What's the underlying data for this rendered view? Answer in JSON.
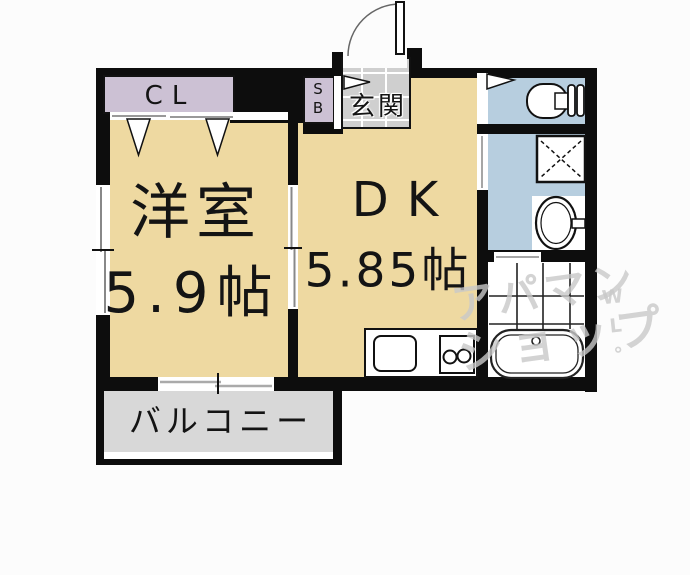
{
  "floorplan": {
    "labels": {
      "closet": "CL",
      "shoe_box": "SB",
      "entrance": "玄関",
      "western_room": "洋室",
      "western_room_size": "5.9帖",
      "dining_kitchen": "DK",
      "dining_kitchen_size": "5.85帖",
      "balcony": "バルコニー"
    },
    "watermark": {
      "line1": "アパマン",
      "line2": "ショップ",
      "side": "WL°"
    },
    "fixtures": [
      "entrance-door-swing",
      "door-flag-entrance",
      "door-flag-toilet",
      "toilet",
      "washing-machine-pan",
      "wash-basin",
      "bathtub",
      "bath-tiles",
      "kitchen-counter",
      "kitchen-sink",
      "gas-stove",
      "closet-folding-doors",
      "sliding-window-left",
      "sliding-window-balcony",
      "sliding-door-room-divider",
      "washroom-door",
      "bath-door"
    ],
    "colors": {
      "wall": "#0d0d0d",
      "room_tan": "#eed9a1",
      "closet_lavender": "#ccc1d4",
      "water_blue": "#b7cedf",
      "entrance_tile": "#cfcfcf",
      "balcony_grey": "#d8d8d8",
      "background": "#fcfcfc",
      "watermark_grey": "#c9c9c9"
    }
  }
}
